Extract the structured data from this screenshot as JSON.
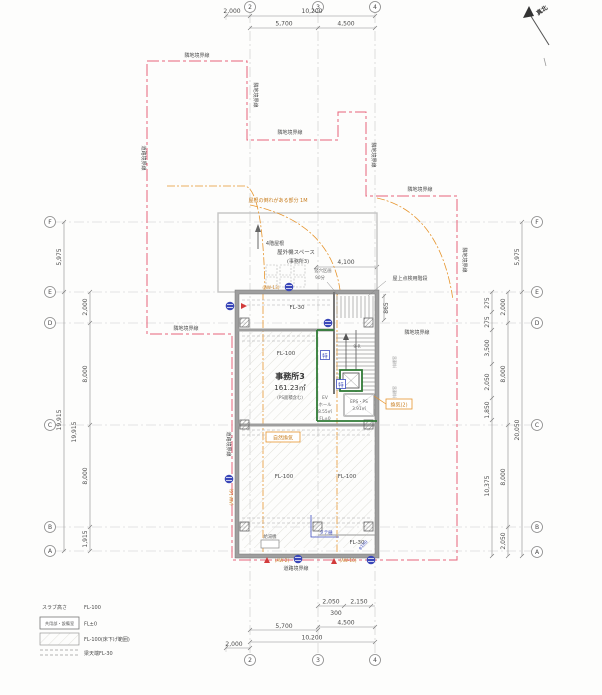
{
  "colors": {
    "boundary": "#e8637a",
    "accent_orange": "#e6952e",
    "accent_blue": "#3c4bbf",
    "fire_green": "#2f7a35",
    "wall_gray": "#9e9e9e"
  },
  "labels": {
    "north": "真北",
    "g2": "2",
    "g3": "3",
    "g4": "4",
    "gF": "F",
    "gE": "E",
    "gD": "D",
    "gC": "C",
    "gB": "B",
    "gA": "A",
    "d2000": "2,000",
    "d10200": "10,200",
    "d5700": "5,700",
    "d4500": "4,500",
    "d2050": "2,050",
    "d2150": "2,150",
    "d300": "300",
    "d5975": "5,975",
    "d19915": "19,915",
    "d8000": "8,000",
    "d1915": "1,915",
    "d275": "275",
    "d3500": "3,500",
    "d1850": "1,850",
    "d10375": "10,375",
    "d20050": "20,050",
    "d865": "865",
    "d4100": "4,100",
    "adjacent_boundary": "隣地境界線",
    "road_boundary": "道路境界線",
    "roof_note": "屋根の倒れがある部分 1M",
    "roof_4f": "4階屋根",
    "outdoor_unit": "屋外機スペース",
    "outdoor_unit_sub": "(事務所3)",
    "roof_stair": "屋上点検用階段",
    "shaft1": "竪穴区画",
    "shaft2": "90分",
    "fl30": "FL-30",
    "fl100": "FL-100",
    "fl0": "FL±0",
    "office": "事務所3",
    "office_area": "161.23㎡",
    "office_sub": "(PS面積含む)",
    "ev": "EV",
    "ev_hall": "ホール",
    "ev_area": "8.55㎡",
    "eps": "EPS・PS",
    "eps_area": "3.91㎡",
    "toku": "特",
    "natural_vent": "自然換気",
    "vent2": "換気(2)",
    "water_heater": "給湯機",
    "aw2": "(AW-2)",
    "aw10": "(AW-10)",
    "aw13": "(AW-13)",
    "aw16": "(AW-16)",
    "stair_note": "9-R",
    "smoke": "排煙窓",
    "downpipe": "タテ樋",
    "pipe": "φ100"
  },
  "legend": {
    "slab_label": "スラブ高さ",
    "slab_value": "FL-100",
    "common_box": "共用部・設備室",
    "common_value": "FL±0",
    "lowered_value": "FL-100(床下げ範囲)",
    "beam_value": "梁天端FL-30"
  }
}
